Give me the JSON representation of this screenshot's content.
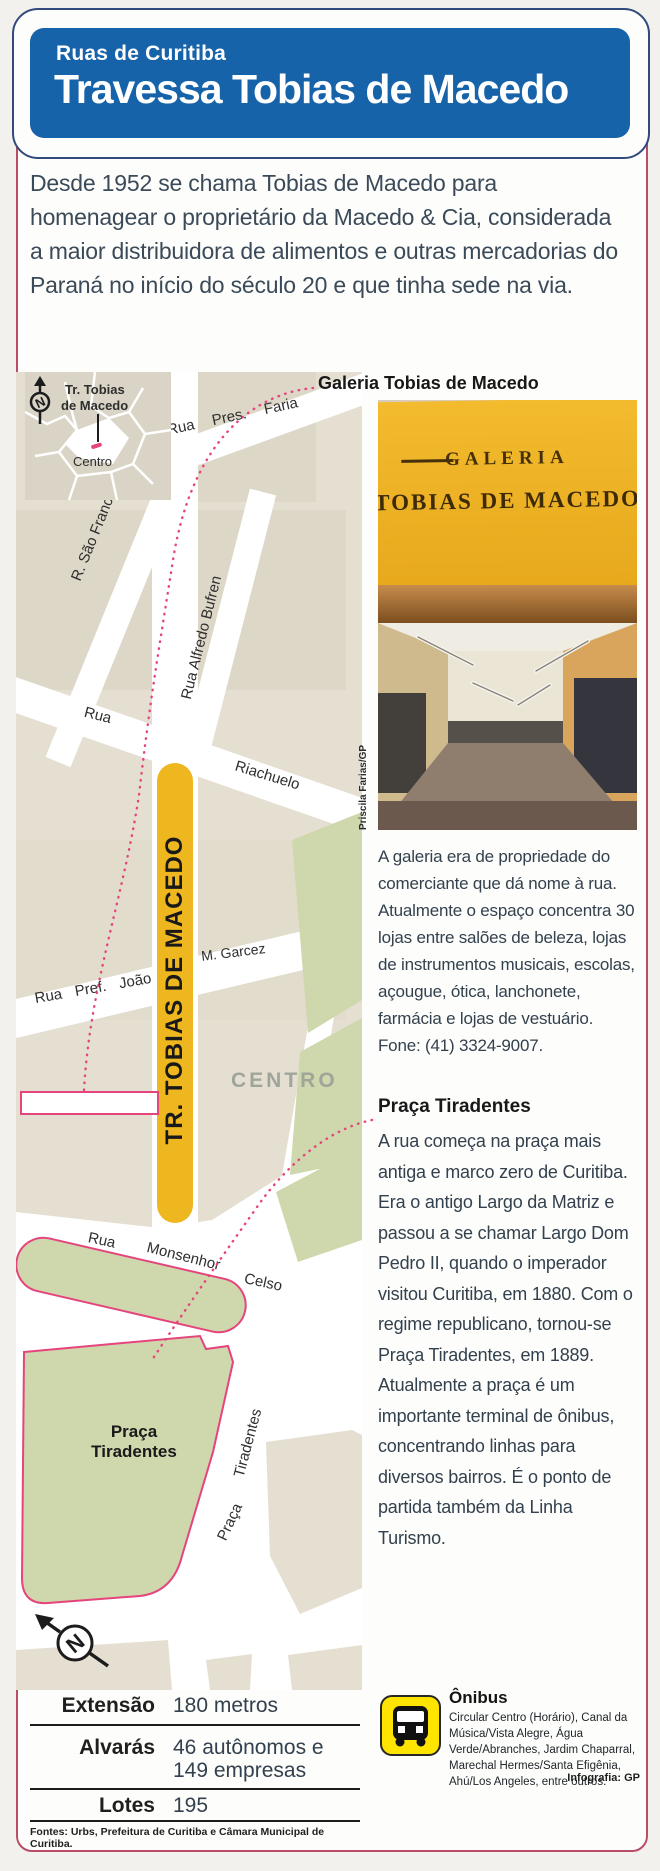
{
  "colors": {
    "header_blue": "#1763aa",
    "header_outline": "#31497c",
    "card_border": "#b84d66",
    "map_beige": "#e5dfd2",
    "block_beige": "#ded8c9",
    "green": "#cfd8ac",
    "street_yellow": "#efb71f",
    "pink": "#e5447c",
    "body_text": "#33414e",
    "bus_yellow": "#ffe400"
  },
  "header": {
    "kicker": "Ruas de Curitiba",
    "title": "Travessa Tobias de Macedo"
  },
  "intro": "Desde 1952 se chama Tobias de Macedo para homenagear o proprietário da Macedo & Cia, considerada a maior distribuidora de alimentos e outras mercadorias do Paraná no início do século 20 e que tinha sede na via.",
  "inset": {
    "street_line1": "Tr. Tobias",
    "street_line2": "de Macedo",
    "district": "Centro"
  },
  "map": {
    "highlight": "TR. TOBIAS DE MACEDO",
    "centro": "CENTRO",
    "praca_line1": "Praça",
    "praca_line2": "Tiradentes",
    "streets": {
      "pres_faria": "Rua Pres. Faria",
      "sao_francisco": "R. São Francisco",
      "alfredo_bufren": "Rua Alfredo Bufren",
      "rua": "Rua",
      "riachuelo": "Riachuelo",
      "pref_joao": "Rua Pref. João",
      "m_garcez": "M. Garcez",
      "rua2": "Rua",
      "monsenhor": "Monsenhor",
      "celso": "Celso",
      "tiradentes_st": "Tiradentes",
      "praca_st": "Praça"
    }
  },
  "galeria": {
    "heading": "Galeria Tobias de Macedo",
    "photo_credit": "Priscila Farias/GP",
    "sign_top": "GALERIA",
    "sign_bottom": "TOBIAS DE MACEDO",
    "body": "A galeria era de propriedade do comerciante que dá nome à rua. Atualmente o espaço concentra 30 lojas entre salões de beleza, lojas de instrumentos musicais, escolas, açougue, ótica, lanchonete, farmácia e lojas de vestuário. Fone: (41) 3324-9007."
  },
  "praca": {
    "heading": "Praça Tiradentes",
    "body": "A rua começa na praça mais antiga e marco zero de Curitiba. Era o antigo Largo da Matriz e passou a se chamar Largo Dom Pedro II, quando o imperador visitou Curitiba, em 1880. Com o regime republicano, tornou-se Praça Tiradentes, em 1889. Atualmente a praça é um importante terminal de ônibus, concentrando linhas para diversos bairros. É o ponto de partida também da Linha Turismo."
  },
  "stats": {
    "rows": [
      {
        "label": "Extensão",
        "value": "180 metros"
      },
      {
        "label": "Alvarás",
        "value": "46 autônomos e 149 empresas"
      },
      {
        "label": "Lotes",
        "value": "195"
      }
    ],
    "sources": "Fontes: Urbs, Prefeitura de Curitiba e Câmara Municipal de Curitiba."
  },
  "onibus": {
    "heading": "Ônibus",
    "body": "Circular Centro (Horário), Canal da Música/Vista Alegre, Água Verde/Abranches, Jardim Chaparral, Marechal Hermes/Santa Efigênia, Ahú/Los Angeles, entre outros."
  },
  "credit": "Infografia: GP"
}
